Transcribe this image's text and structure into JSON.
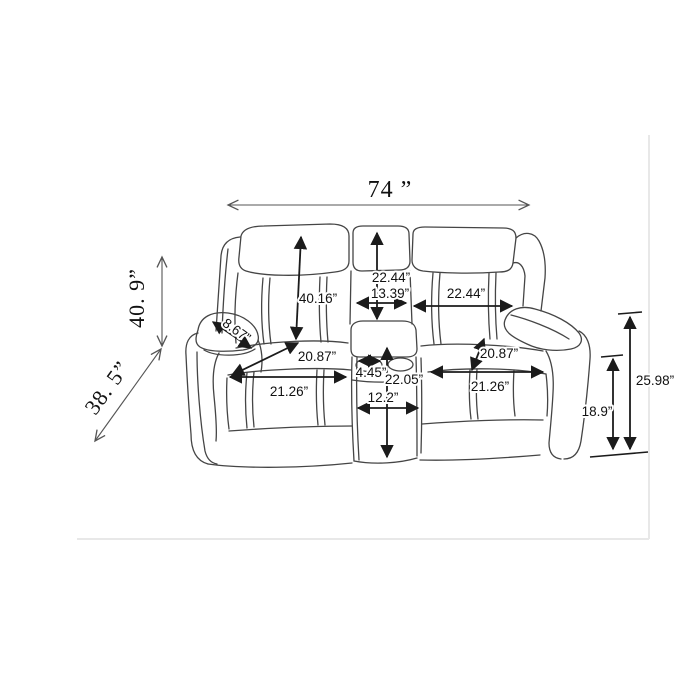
{
  "figure": {
    "type": "furniture-dimension-diagram",
    "subject": "reclining loveseat with center storage console and cupholders"
  },
  "colors": {
    "background": "#ffffff",
    "sofa_line": "#454545",
    "arrow": "#1b1b1b",
    "thin_arrow": "#555555",
    "label_text": "#111111",
    "photo_frame": "#e8e8e8"
  },
  "dims": {
    "total_width": "74 ”",
    "total_height": "40. 9”",
    "total_depth": "38. 5”",
    "back_height": "40.16”",
    "console_back_height": "22.44”",
    "console_top_width": "13.39”",
    "backrest_width": "22.44”",
    "seat_depth_left": "20.87”",
    "seat_width_left": "21.26”",
    "armrest_width": "8.67”",
    "cupholder_width": "4.45”",
    "console_height": "22.05”",
    "console_base_width": "12.2”",
    "seat_depth_right": "20.87”",
    "seat_width_right": "21.26”",
    "seat_height": "18.9”",
    "arm_height": "25.98”"
  }
}
